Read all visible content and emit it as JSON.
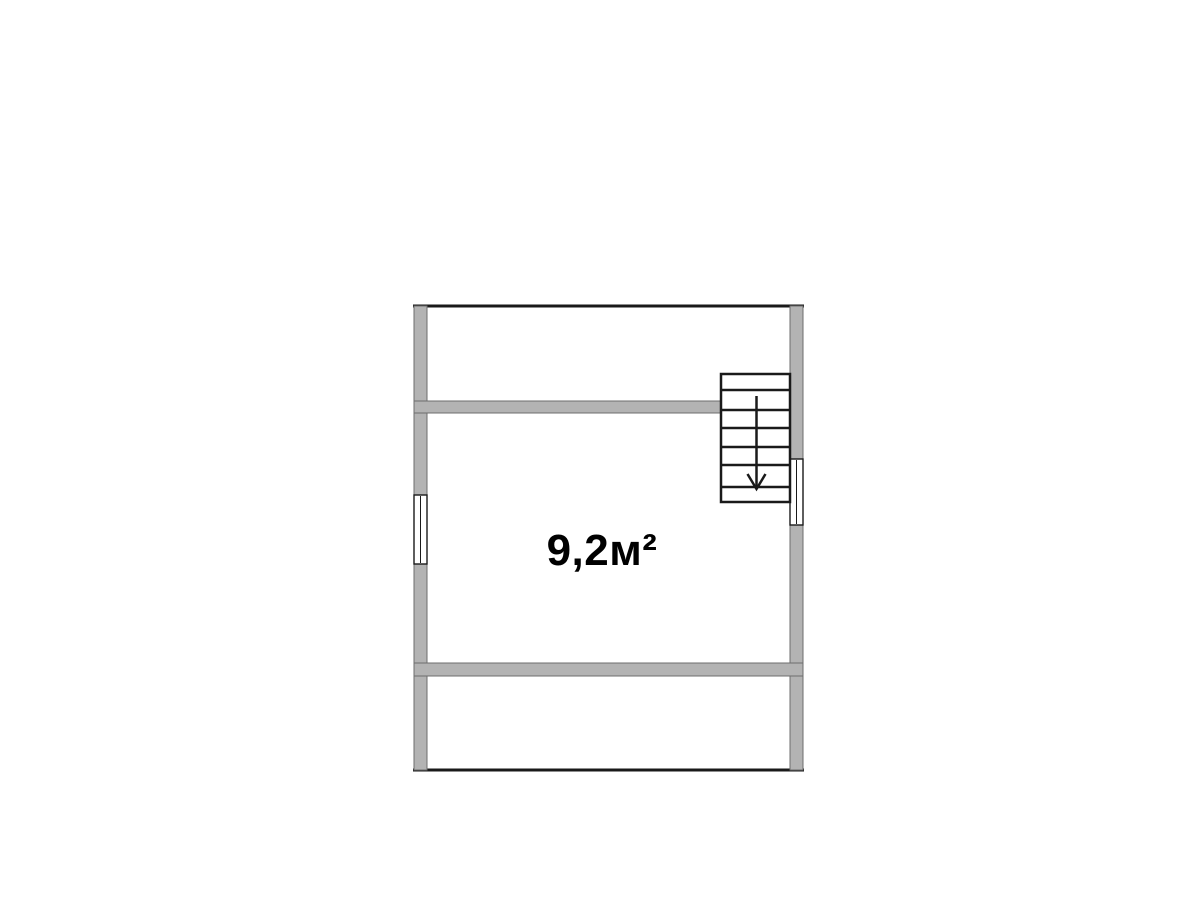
{
  "floor_plan": {
    "area_label": "9,2м²",
    "stairs": {
      "direction": "down",
      "visible_steps": 7
    },
    "windows_count": 2
  },
  "colors": {
    "background": "#ffffff",
    "room_fill": "#ffffff",
    "wall_fill": "#b3b3b3",
    "wall_stroke": "#6e6e6e",
    "line_color": "#1a1a1a",
    "label_color": "#000000"
  }
}
